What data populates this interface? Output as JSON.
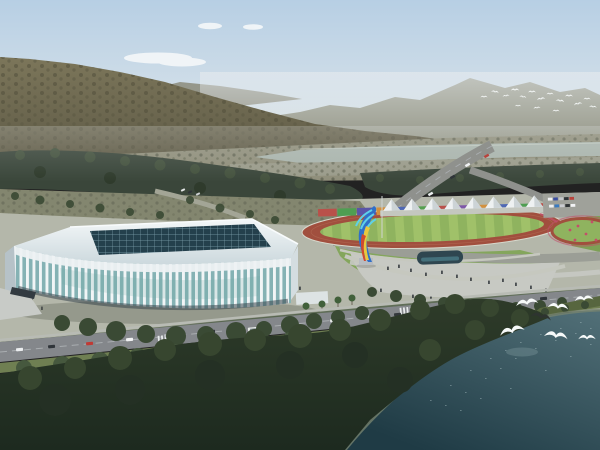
{
  "scene": {
    "label": "aerial-rendering-sports-complex",
    "description": "Aerial rendering: white ribbed arena beside athletics track with colorful panels, tents, flame sculpture, mountains, river and waterfront forest with white birds"
  },
  "palette": {
    "sky_top": "#b7cfe4",
    "sky_mid": "#cfdde8",
    "sky_horizon": "#e4e7e3",
    "cloud": "#f5f8f9",
    "haze": "#e9edef",
    "mountain_far": "#97998a",
    "ridge": "#8b8b7a",
    "mountain_top": "#7c765a",
    "mountain_bottom": "#5e5a46",
    "mountain_dot_a": "#4e4b38",
    "mountain_dot_b": "#5a5742",
    "scrubland": "#8f8e7a",
    "scrub_dot_a": "#5d6050",
    "scrub_dot_b": "#6a6d58",
    "river": "#a9b4ac",
    "river_glint": "#c6cec5",
    "shore": "#9a9b8a",
    "forest": "#3a463a",
    "forest_dot_a": "#44523e",
    "forest_dot_b": "#2f3b2c",
    "grove_ground": "#83866f",
    "grove_road": "#a3a596",
    "park_ground": "#b4b7aa",
    "plaza": "#c7c9c3",
    "park_road": "#9b9e96",
    "lawn": "#84a65c",
    "lawn_dark": "#7da055",
    "lawn_path": "#c6c8bf",
    "track": "#a14f3e",
    "track_lane": "#b06a52",
    "track_rim": "#d8d8cc",
    "field_a": "#8fb35f",
    "field_b": "#a0c169",
    "tent_light": "#eef1f2",
    "tent_shade": "#ccd3d6",
    "tent_base": "#c4c7bf",
    "parking_lot": "#9fa19a",
    "pool": "#2f4650",
    "pool_glint": "#4a7a86",
    "sculpture_blue": "#2f6fc8",
    "sculpture_cyan": "#5fd0e8",
    "sculpture_yellow": "#e8c83e",
    "sculpture_red": "#cf4a30",
    "pedestal": "#b8bcc0",
    "flower": "#c2506a",
    "people": "#2c3136",
    "roof_light": "#f3f7f8",
    "roof_dark": "#c9d6db",
    "roof_highlight": "#f8fbfc",
    "skylight": "#24404c",
    "skylight_grid": "#7fa2ae",
    "glass": "#85b2b4",
    "rib": "#f1f5f6",
    "fascia": "#edf1f3",
    "glass_tint": "#6aa7a2",
    "stadium_base": "#39464c",
    "side_face": "#b6c2c8",
    "right_face": "#d4dde0",
    "steps": "#c8cbc7",
    "canopy": "#333b41",
    "annex": "#dde3e4",
    "palm": "#41603a",
    "trunk": "#6b6458",
    "mast": "#cfd4d4",
    "sidewalk": "#b8bbb4",
    "hedge": "#4a5a42",
    "road": "#84878b",
    "road_line": "#a9adb0",
    "crosswalk": "#e8ebec",
    "verge": "#6f7f52",
    "bank": "#57663f",
    "tree_mid": "#3a4a34",
    "tree_light": "#46583e",
    "fg_forest_top": "#2e3b29",
    "fg_forest_bottom": "#1d2a1f",
    "fg_dot_a": "#37462f",
    "fg_dot_b": "#243024",
    "water_top": "#527078",
    "water_bottom": "#1f3b45",
    "water_glint": "#9fb6ba",
    "water_glow": "#8fa8ac",
    "shore_line": "#76836f",
    "bird_white": "#f6f9f9",
    "bird_dark": "#2e3430",
    "shadow": "#5d6257",
    "highway": "#8f918d",
    "bus_window": "#7f8a90"
  },
  "park": {
    "wall_colors": [
      "#b9514a",
      "#4f9e52",
      "#5a55a8",
      "#d2913f",
      "#4f68b4",
      "#55a04f",
      "#b9514a",
      "#7e57a8",
      "#d2913f",
      "#4f68b4",
      "#4f9e52",
      "#b9514a"
    ]
  },
  "tents": {
    "count": 8
  },
  "birds": {
    "distant_count": 16,
    "foreground_count": 7
  },
  "cars": {
    "bus": "#e9ece9",
    "road": [
      "#eceef0",
      "#30353a",
      "#c03a34",
      "#f2f3f4",
      "#b9bcc0",
      "#2e3337",
      "#e6e9e6",
      "#ffffff",
      "#33383c",
      "#c03a34",
      "#eef0f1",
      "#2f343a"
    ],
    "parking": [
      "#f0f1f3",
      "#3a4da0",
      "#c4c6ca",
      "#303438",
      "#b8433c",
      "#eef0f2",
      "#3a7ac0",
      "#caccd0",
      "#2f3335",
      "#f2f3f5"
    ],
    "highway": [
      "#f0f2f3",
      "#2f3438",
      "#b8433c",
      "#eceff0"
    ],
    "left": [
      "#e8eaea",
      "#2f3338",
      "#cfd2d4"
    ]
  }
}
